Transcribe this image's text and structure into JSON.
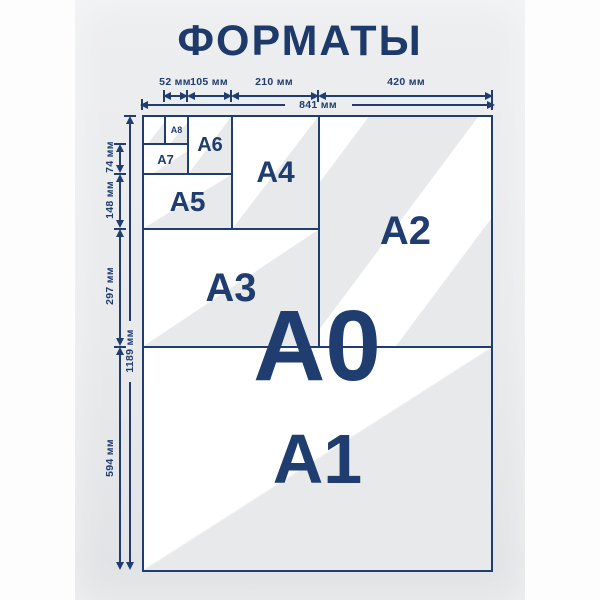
{
  "title": "ФОРМАТЫ",
  "colors": {
    "accent_navy": "#1f3d6f",
    "paper_white": "#ffffff",
    "paper_gray": "#e8e9ea",
    "panel_gray_top": "#edeef0",
    "panel_gray_bottom": "#e1e2e5"
  },
  "cells": {
    "a0": "A0",
    "a1": "A1",
    "a2": "A2",
    "a3": "A3",
    "a4": "A4",
    "a5": "A5",
    "a6": "A6",
    "a7": "A7",
    "a8": "A8"
  },
  "dims": {
    "w_a8": "52 мм",
    "w_a6": "105 мм",
    "w_a4": "210 мм",
    "w_a2": "420 мм",
    "w_total": "841 мм",
    "h_a7": "74 мм",
    "h_a5": "148 мм",
    "h_a3": "297 мм",
    "h_a1": "594 мм",
    "h_total": "1189 мм"
  }
}
